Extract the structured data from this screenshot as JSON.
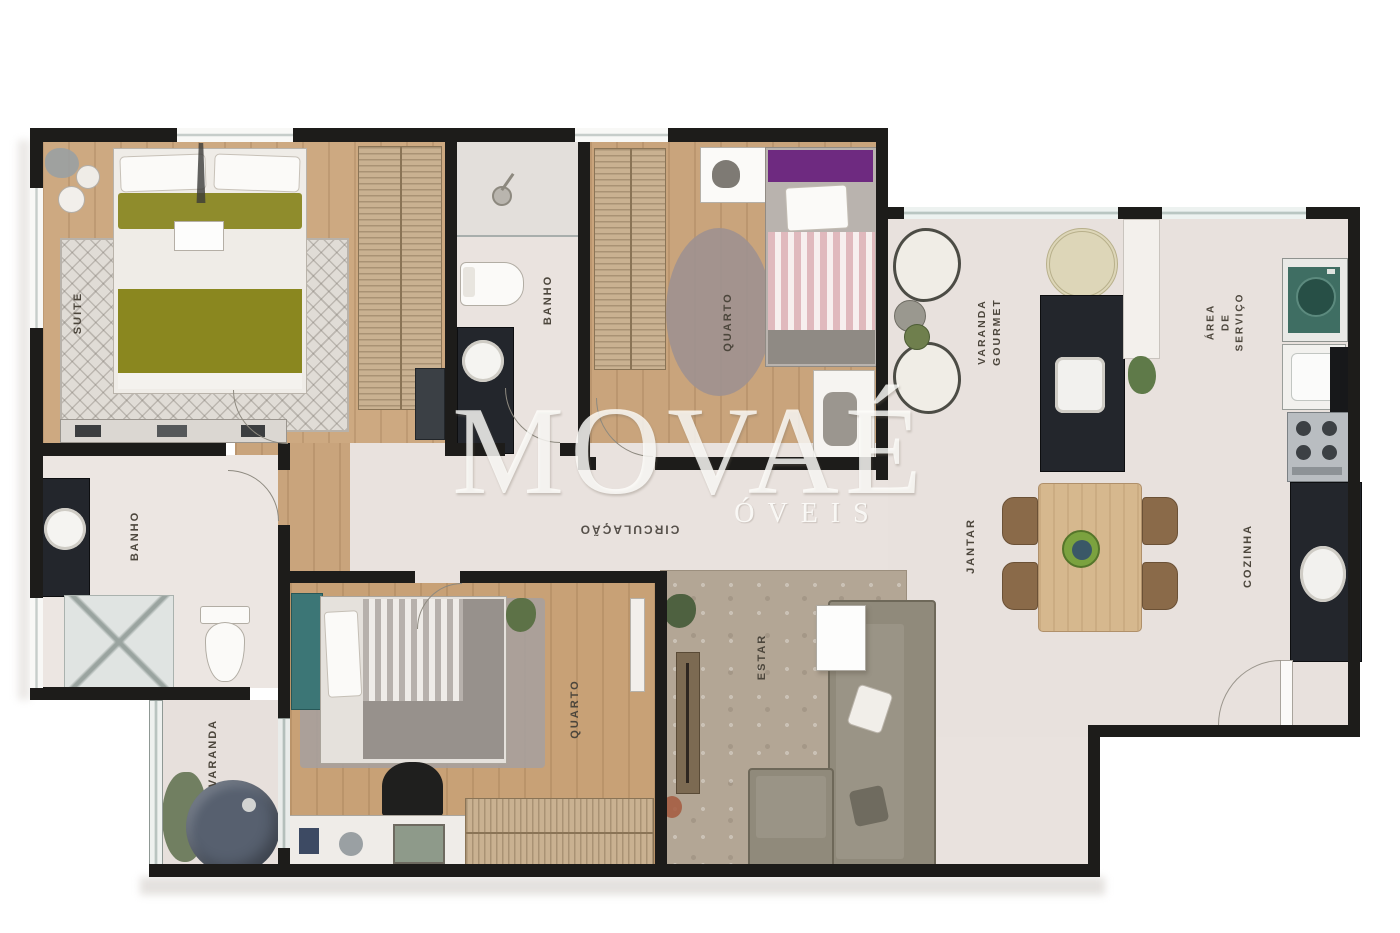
{
  "watermark": {
    "brand": "MOVAÉ",
    "sub": "ÓVEIS"
  },
  "rooms": {
    "suite": {
      "label": "SUITE"
    },
    "banho_suite": {
      "label": "BANHO"
    },
    "quarto_top": {
      "label": "QUARTO"
    },
    "varanda_gourmet": {
      "label": "VARANDA\nGOURMET"
    },
    "area_servico": {
      "label": "ÁREA\nDE\nSERVIÇO"
    },
    "cozinha": {
      "label": "COZINHA"
    },
    "jantar": {
      "label": "JANTAR"
    },
    "circulacao": {
      "label": "CIRCULAÇÃO"
    },
    "estar": {
      "label": "ESTAR"
    },
    "quarto_bottom": {
      "label": "QUARTO"
    },
    "banho_social": {
      "label": "BANHO"
    },
    "varanda": {
      "label": "VARANDA"
    }
  },
  "palette": {
    "wall": "#1d1c1a",
    "wood_floor": "#c9a47c",
    "light_floor": "#eae3df",
    "counter_granite": "#23262c",
    "suite_bedding_olive": "#8a871f",
    "quarto_top_pillow_purple": "#6e2a80",
    "quarto_bottom_headboard_teal": "#3c7676",
    "washer_teal": "#3f6e63",
    "varanda_table_slate": "#57606f",
    "dining_wood": "#d6b88e",
    "label_text": "#4c463c"
  }
}
